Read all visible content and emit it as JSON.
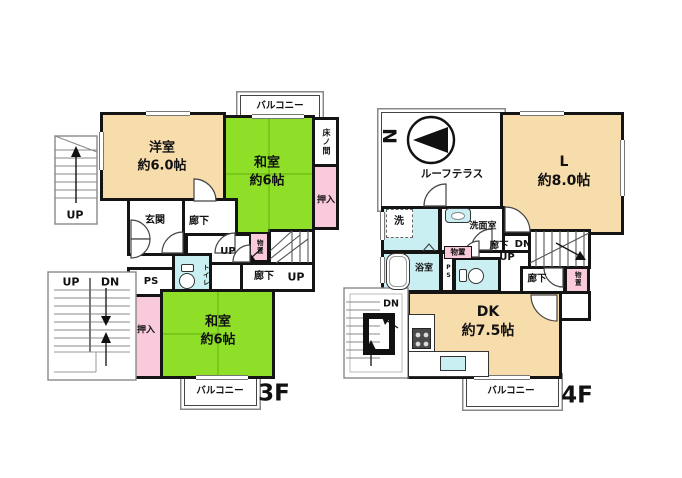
{
  "figure": {
    "type": "floorplan",
    "floors_shown": [
      "3F",
      "4F"
    ]
  },
  "colors": {
    "western_room": "#F8DDAC",
    "tatami_room": "#8FDF29",
    "closet_pink": "#F9C9DC",
    "wet_area_blue": "#C9EFF2",
    "wall": "#141414"
  },
  "f3": {
    "floor_label": "3F",
    "balcony_top": "バルコニー",
    "balcony_bottom": "バルコニー",
    "youshitsu": {
      "name": "洋室",
      "size": "約6.0帖"
    },
    "washitsu_a": {
      "name": "和室",
      "size": "約6帖"
    },
    "washitsu_b": {
      "name": "和室",
      "size": "約6帖"
    },
    "tokonoma": "床ノ間",
    "oshiire_a": "押入",
    "oshiire_b": "押入",
    "genkan": "玄関",
    "rouka_a": "廊下",
    "rouka_b": "廊下",
    "toilet": "トイレ",
    "ps": "PS",
    "monooki": "物置",
    "stair_up": "UP",
    "hall_up": "UP",
    "ext_up_top": "UP",
    "ext_up_bottom": "UP",
    "ext_dn_bottom": "DN"
  },
  "f4": {
    "floor_label": "4F",
    "compass_n": "N",
    "roof_terrace": "ルーフテラス",
    "living": {
      "name": "L",
      "size": "約8.0帖"
    },
    "dk": {
      "name": "DK",
      "size": "約7.5帖"
    },
    "laundry": "洗",
    "senmenshitsu": "洗面室",
    "yokushitsu": "浴室",
    "ps": "PS",
    "monooki_a": "物置",
    "monooki_b": "物置",
    "rouka_a": "廊下",
    "rouka_b": "廊下",
    "stair_dn": "DN",
    "stair_up": "UP",
    "ext_dn": "DN",
    "balcony": "バルコニー"
  }
}
